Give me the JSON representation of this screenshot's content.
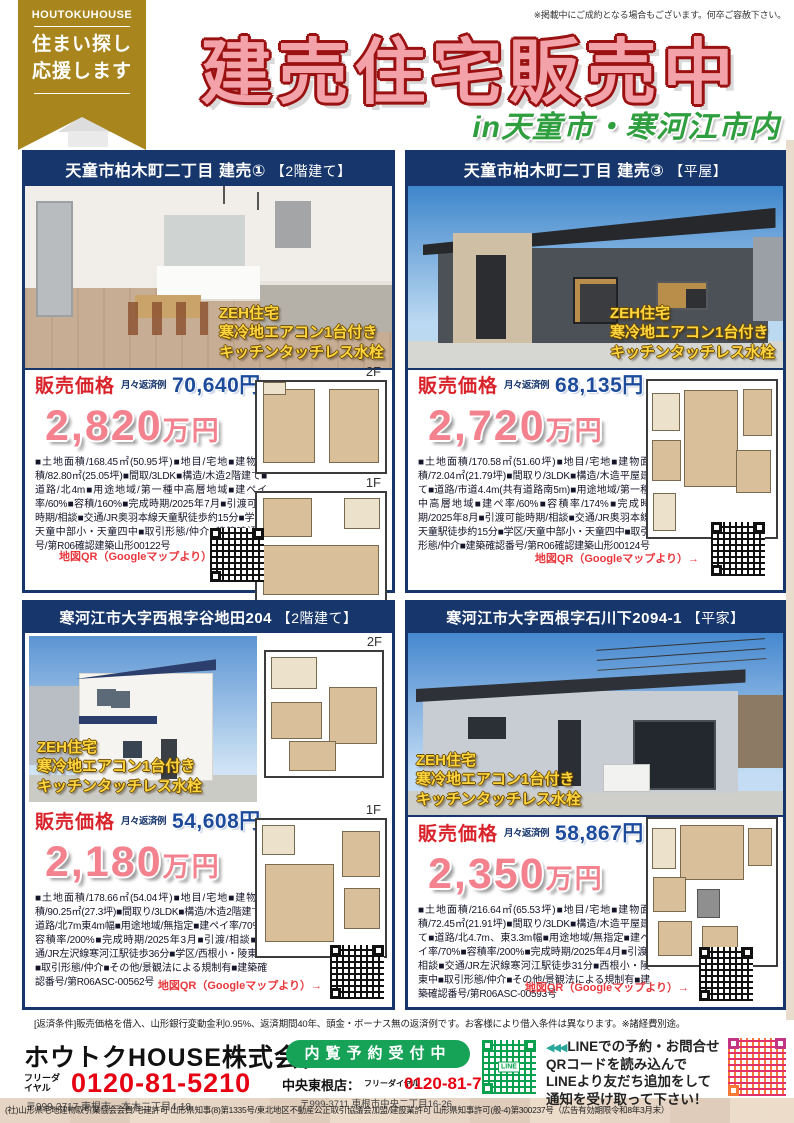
{
  "page": {
    "top_note": "※掲載中にご成約となる場合もございます。何卒ご容赦下さい。"
  },
  "header": {
    "brand": "HOUTOKUHOUSE",
    "ribbon_line1": "住まい探し",
    "ribbon_line2": "応援します",
    "title": "建売住宅販売中",
    "subtitle": "in天童市・寒河江市内"
  },
  "labels": {
    "price_label": "販売価格",
    "monthly_label": "月々返済例",
    "price_unit": "万円",
    "map_qr": "地図QR（Googleマップより）→",
    "zeh": [
      "ZEH住宅",
      "寒冷地エアコン1台付き",
      "キッチンタッチレス水栓"
    ],
    "floor_2f": "2F",
    "floor_1f": "1F"
  },
  "properties": [
    {
      "title": "天童市柏木町二丁目  建売①",
      "type_tag": "【2階建て】",
      "monthly": "70,640円",
      "price": "2,820",
      "details": "■土地面積/168.45㎡(50.95坪)■地目/宅地■建物面積/82.80㎡(25.05坪)■間取/3LDK■構造/木造2階建て■道路/北4m■用途地域/第一種中高層地域■建ペイ率/60%■容積/160%■完成時期/2025年7月■引渡可能時期/相談■交通/JR奥羽本線天童駅徒歩約15分■学区/天童中部小・天童四中■取引形態/仲介■建築確認番号/第R06確認建築山形00122号"
    },
    {
      "title": "天童市柏木町二丁目  建売③",
      "type_tag": "【平屋】",
      "monthly": "68,135円",
      "price": "2,720",
      "details": "■土地面積/170.58㎡(51.60坪)■地目/宅地■建物面積/72.04㎡(21.79坪)■間取り/3LDK■構造/木造平屋建て■道路/市道4.4m(共有道路南5m)■用途地域/第一種中高層地域■建ぺ率/60%■容積率/174%■完成時期/2025年8月■引渡可能時期/相談■交通/JR奥羽本線天童駅徒歩約15分■学区/天童中部小・天童四中■取引形態/仲介■建築確認番号/第R06確認建築山形00124号"
    },
    {
      "title": "寒河江市大字西根字谷地田204",
      "type_tag": "【2階建て】",
      "monthly": "54,608円",
      "price": "2,180",
      "details": "■土地面積/178.66㎡(54.04坪)■地目/宅地■建物面積/90.25㎡(27.3坪)■間取り/3LDK■構造/木造2階建て■道路/北7m東4m幅■用途地域/無指定■建ペイ率/70%■容積率/200%■完成時期/2025年3月■引渡/相談■交通/JR左沢線寒河江駅徒歩36分■学区/西根小・陵東中■取引形態/仲介■その他/景観法による規制有■建築確認番号/第R06ASC-00562号"
    },
    {
      "title": "寒河江市大字西根字石川下2094-1",
      "type_tag": "【平家】",
      "monthly": "58,867円",
      "price": "2,350",
      "details": "■土地面積/216.64㎡(65.53坪)■地目/宅地■建物面積/72.45㎡(21.91坪)■間取り/3LDK■構造/木造平屋建て■道路/北4.7m、東3.3m幅■用途地域/無指定■建ペイ率/70%■容積率/200%■完成時期/2025年4月■引渡/相談■交通/JR左沢線寒河江駅徒歩31分■西根小・陵東中■取引形態/仲介■その他/景観法による規制有■建築確認番号/第R06ASC-00593号"
    }
  ],
  "repayment_note": "[返済条件]販売価格を借入、山形銀行変動金利0.95%、返済期間40年、頭金・ボーナス無の返済例です。お客様により借入条件は異なります。※諸経費別途。",
  "footer": {
    "company": "ホウトクHOUSE株式会社",
    "freedial_label": "フリーダイヤル",
    "phone_main": "0120-81-5210",
    "address_main": "〒999-3717 東根市一本木二丁目4-18",
    "reservation_button": "内覧予約受付中",
    "branch_store": "中央東根店：",
    "phone_branch": "0120-81-7778",
    "address_branch": "〒999-3711 東根市中央二丁目16-26",
    "line_qr_label": "LINE",
    "line_arrows": "◀◀◀",
    "line_lines": [
      "LINEでの予約・お問合せ",
      "QRコードを読み込んで",
      "LINEより友だち追加をして",
      "通知を受け取って下さい！"
    ],
    "license": "(社)山形県宅地建物取引業協会会員/宅建許可 山形県知事(8)第1335号/東北地区不動産公正取引協議会加盟/建設業許可 山形県知事許可(般-4)第300237号（広告有効期限令和8年3月末）"
  },
  "colors": {
    "navy": "#17366b",
    "brand_gold": "#a8861d",
    "title_pink": "#f2a2a8",
    "title_outline": "#9b1010",
    "subtitle_green": "#2f9e3f",
    "button_green": "#17a357",
    "accent_red": "#e60012",
    "map_red": "#e8383d",
    "price_pink": "#f4828e",
    "monthly_blue": "#1d4b9b",
    "zeh_yellow": "#ffd63e"
  }
}
